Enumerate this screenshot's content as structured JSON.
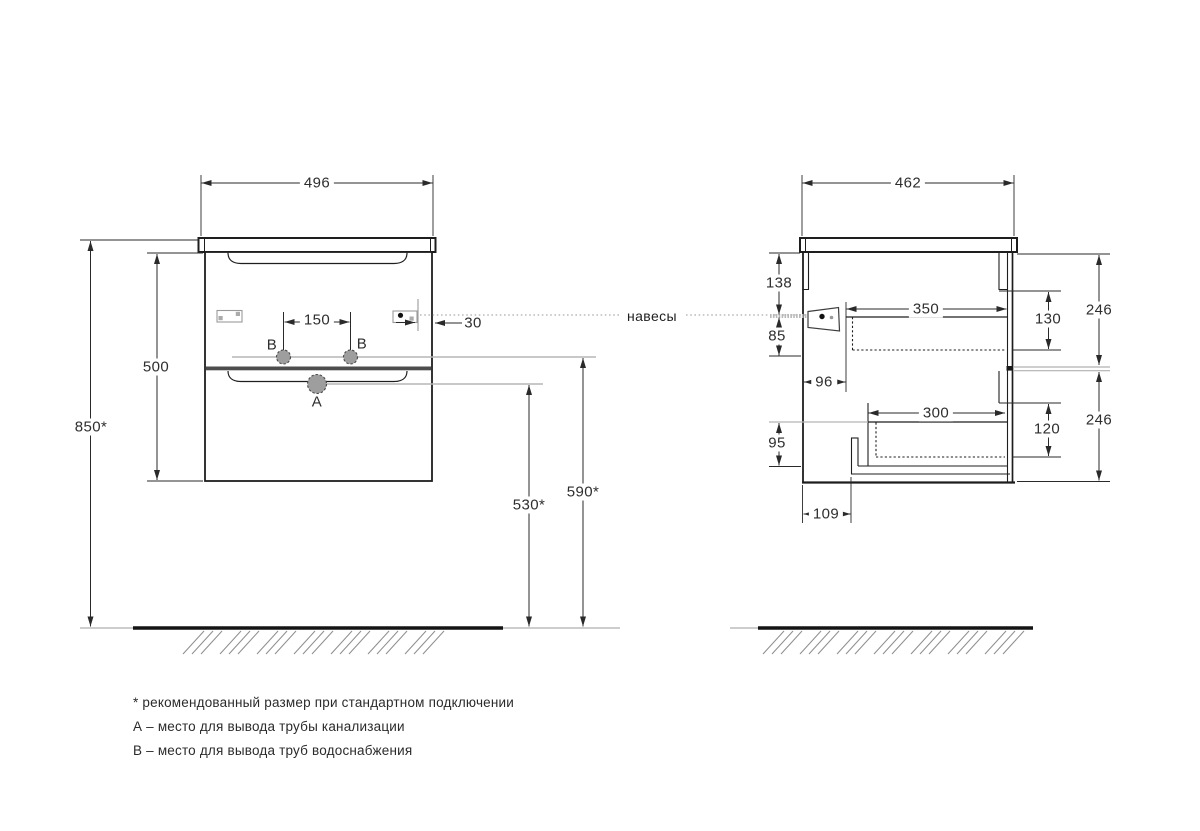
{
  "front_view": {
    "dim_width": "496",
    "dim_height": "500",
    "dim_mount_height": "850*",
    "dim_holes_spacing": "150",
    "dim_bracket_offset": "30",
    "dim_drain_height": "530*",
    "dim_water_height": "590*",
    "label_a": "A",
    "label_b": "B"
  },
  "side_view": {
    "dim_depth": "462",
    "dim_top": "138",
    "dim_hanger": "85",
    "dim_back_offset": "96",
    "dim_bottom": "95",
    "dim_pipe_offset": "109",
    "dim_drawer1_depth": "350",
    "dim_drawer2_depth": "300",
    "dim_inner1": "130",
    "dim_inner2": "120",
    "dim_front1": "246",
    "dim_front2": "246"
  },
  "callout": {
    "hangers": "навесы"
  },
  "notes": {
    "line1": "* рекомендованный размер при стандартном подключении",
    "line2": "А – место для вывода трубы канализации",
    "line3": "В – место для вывода труб водоснабжения"
  },
  "colors": {
    "line": "#1e1e1e",
    "dimension": "#2a2a2a",
    "reference_gray": "#b5b5b5",
    "hatch_gray": "#8f8f8f",
    "hole_fill": "#9e9e9e",
    "divider": "#4d4d4d"
  }
}
